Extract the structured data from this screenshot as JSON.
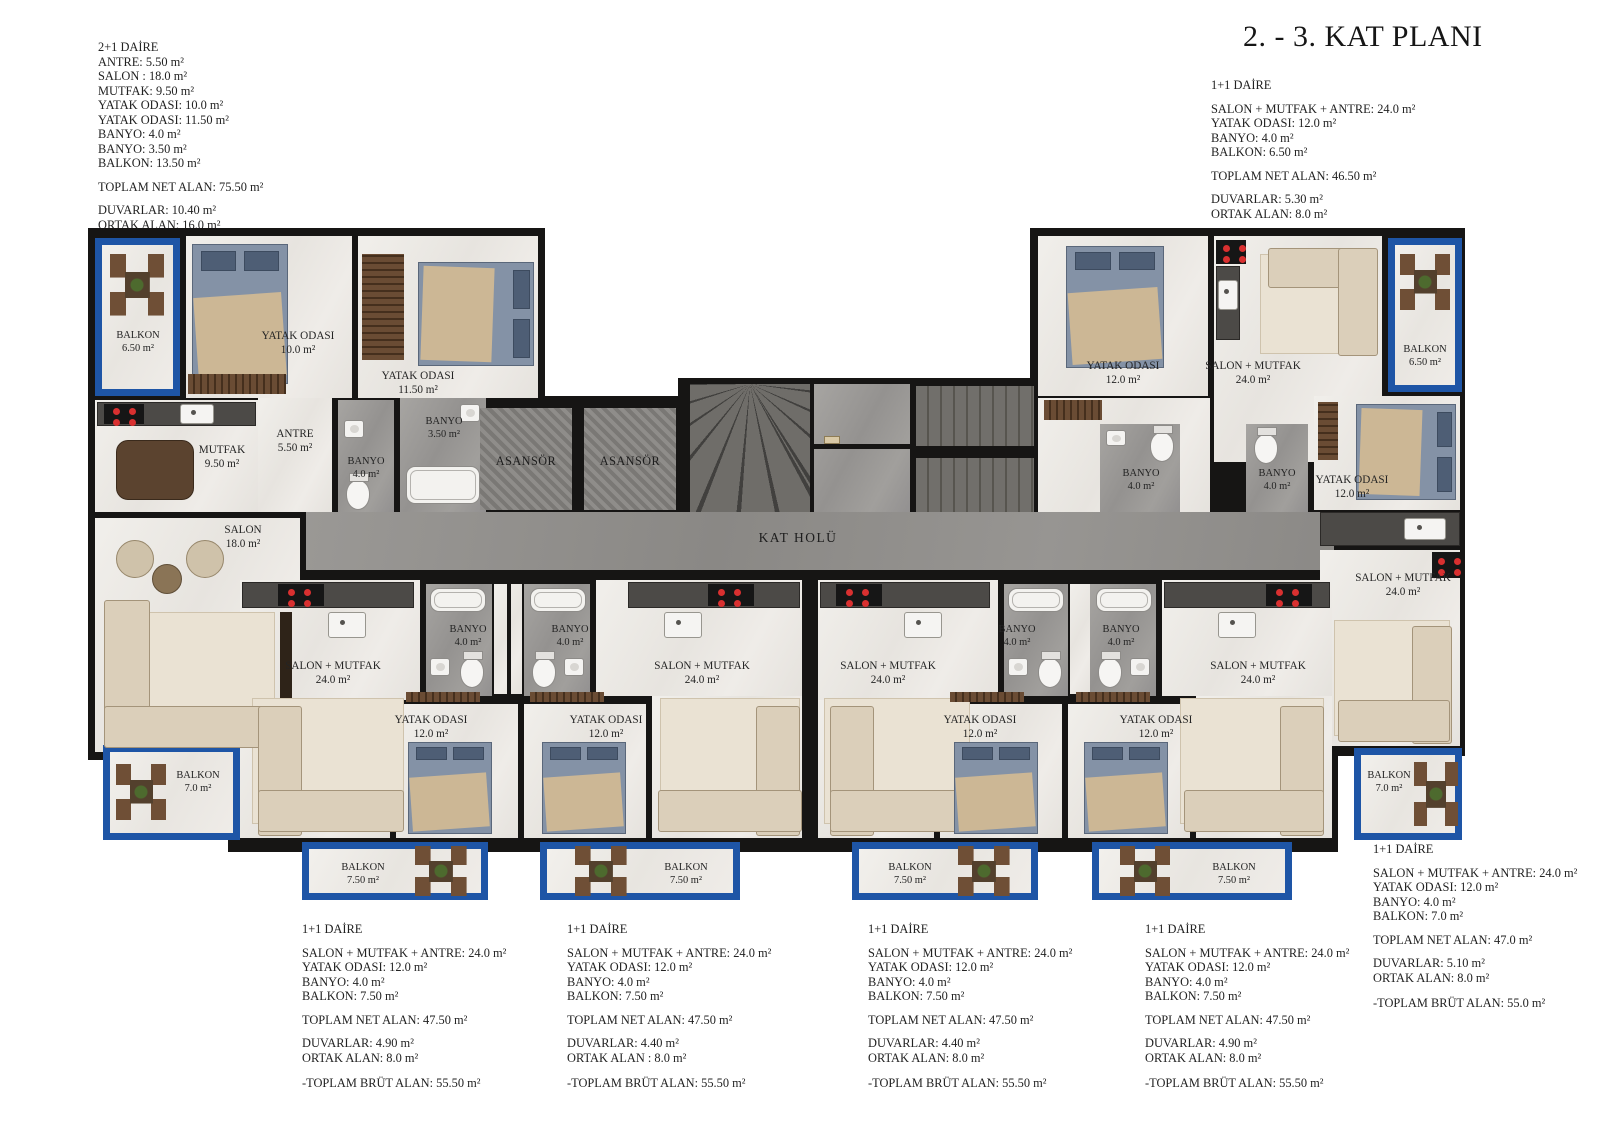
{
  "title": "2. - 3. KAT PLANI",
  "spec_blocks": {
    "apt_2plus1": {
      "heading": "2+1 DAİRE",
      "lines": [
        "ANTRE: 5.50 m²",
        "SALON : 18.0 m²",
        "MUTFAK: 9.50 m²",
        "YATAK ODASI: 10.0 m²",
        "YATAK ODASI: 11.50 m²",
        "BANYO: 4.0 m²",
        "BANYO: 3.50 m²",
        "BALKON: 13.50 m²"
      ],
      "net": "TOPLAM NET ALAN: 75.50 m²",
      "walls": "DUVARLAR: 10.40 m²",
      "common": "ORTAK ALAN: 16.0 m²",
      "gross": "-TOPLAM BRÜT ALAN:  91.50 m²"
    },
    "apt_top_right": {
      "heading": "1+1 DAİRE",
      "lines": [
        "SALON + MUTFAK + ANTRE: 24.0 m²",
        "YATAK ODASI: 12.0 m²",
        "BANYO: 4.0 m²",
        "BALKON: 6.50 m²"
      ],
      "net": "TOPLAM NET ALAN: 46.50 m²",
      "walls": "DUVARLAR: 5.30 m²",
      "common": "ORTAK ALAN: 8.0 m²",
      "gross": "-TOPLAM BRÜT ALAN:  54.50 m²"
    },
    "apt_bottom_1": {
      "heading": "1+1 DAİRE",
      "lines": [
        "SALON + MUTFAK + ANTRE: 24.0 m²",
        "YATAK ODASI: 12.0 m²",
        "BANYO: 4.0 m²",
        "BALKON: 7.50 m²"
      ],
      "net": "TOPLAM NET ALAN: 47.50 m²",
      "walls": "DUVARLAR: 4.90 m²",
      "common": "ORTAK ALAN: 8.0 m²",
      "gross": "-TOPLAM BRÜT ALAN:  55.50 m²"
    },
    "apt_bottom_2": {
      "heading": "1+1 DAİRE",
      "lines": [
        "SALON + MUTFAK + ANTRE: 24.0 m²",
        "YATAK ODASI: 12.0 m²",
        "BANYO: 4.0 m²",
        "BALKON: 7.50 m²"
      ],
      "net": "TOPLAM NET ALAN: 47.50 m²",
      "walls": "DUVARLAR: 4.40 m²",
      "common": "ORTAK ALAN : 8.0 m²",
      "gross": "-TOPLAM BRÜT ALAN:  55.50 m²"
    },
    "apt_bottom_3": {
      "heading": "1+1 DAİRE",
      "lines": [
        "SALON + MUTFAK + ANTRE: 24.0 m²",
        "YATAK ODASI: 12.0 m²",
        "BANYO: 4.0 m²",
        "BALKON: 7.50 m²"
      ],
      "net": "TOPLAM NET ALAN: 47.50 m²",
      "walls": "DUVARLAR: 4.40 m²",
      "common": "ORTAK ALAN: 8.0 m²",
      "gross": "-TOPLAM BRÜT ALAN:  55.50 m²"
    },
    "apt_bottom_4": {
      "heading": "1+1 DAİRE",
      "lines": [
        "SALON + MUTFAK + ANTRE: 24.0 m²",
        "YATAK ODASI: 12.0 m²",
        "BANYO: 4.0 m²",
        "BALKON: 7.50 m²"
      ],
      "net": "TOPLAM NET ALAN: 47.50 m²",
      "walls": "DUVARLAR: 4.90 m²",
      "common": "ORTAK ALAN: 8.0 m²",
      "gross": "-TOPLAM BRÜT ALAN:  55.50 m²"
    },
    "apt_right": {
      "heading": "1+1 DAİRE",
      "lines": [
        "SALON + MUTFAK + ANTRE: 24.0 m²",
        "YATAK ODASI: 12.0 m²",
        "BANYO: 4.0 m²",
        "BALKON: 7.0 m²"
      ],
      "net": "TOPLAM NET ALAN: 47.0 m²",
      "walls": "DUVARLAR: 5.10 m²",
      "common": "ORTAK ALAN: 8.0 m²",
      "gross": "-TOPLAM BRÜT ALAN:  55.0 m²"
    }
  },
  "plan": {
    "rooms": {
      "balkon_65": {
        "name": "BALKON",
        "area": "6.50 m²"
      },
      "balkon_70": {
        "name": "BALKON",
        "area": "7.0 m²"
      },
      "balkon_75": {
        "name": "BALKON",
        "area": "7.50 m²"
      },
      "yatak_10": {
        "name": "YATAK ODASI",
        "area": "10.0 m²"
      },
      "yatak_115": {
        "name": "YATAK ODASI",
        "area": "11.50 m²"
      },
      "yatak_12": {
        "name": "YATAK ODASI",
        "area": "12.0 m²"
      },
      "antre": {
        "name": "ANTRE",
        "area": "5.50 m²"
      },
      "mutfak": {
        "name": "MUTFAK",
        "area": "9.50 m²"
      },
      "banyo_40": {
        "name": "BANYO",
        "area": "4.0 m²"
      },
      "banyo_35": {
        "name": "BANYO",
        "area": "3.50 m²"
      },
      "salon_18": {
        "name": "SALON",
        "area": "18.0 m²"
      },
      "salon_mutfak_24": {
        "name": "SALON + MUTFAK",
        "area": "24.0 m²"
      },
      "asansor": "ASANSÖR",
      "kat_holu": "KAT HOLÜ"
    }
  }
}
